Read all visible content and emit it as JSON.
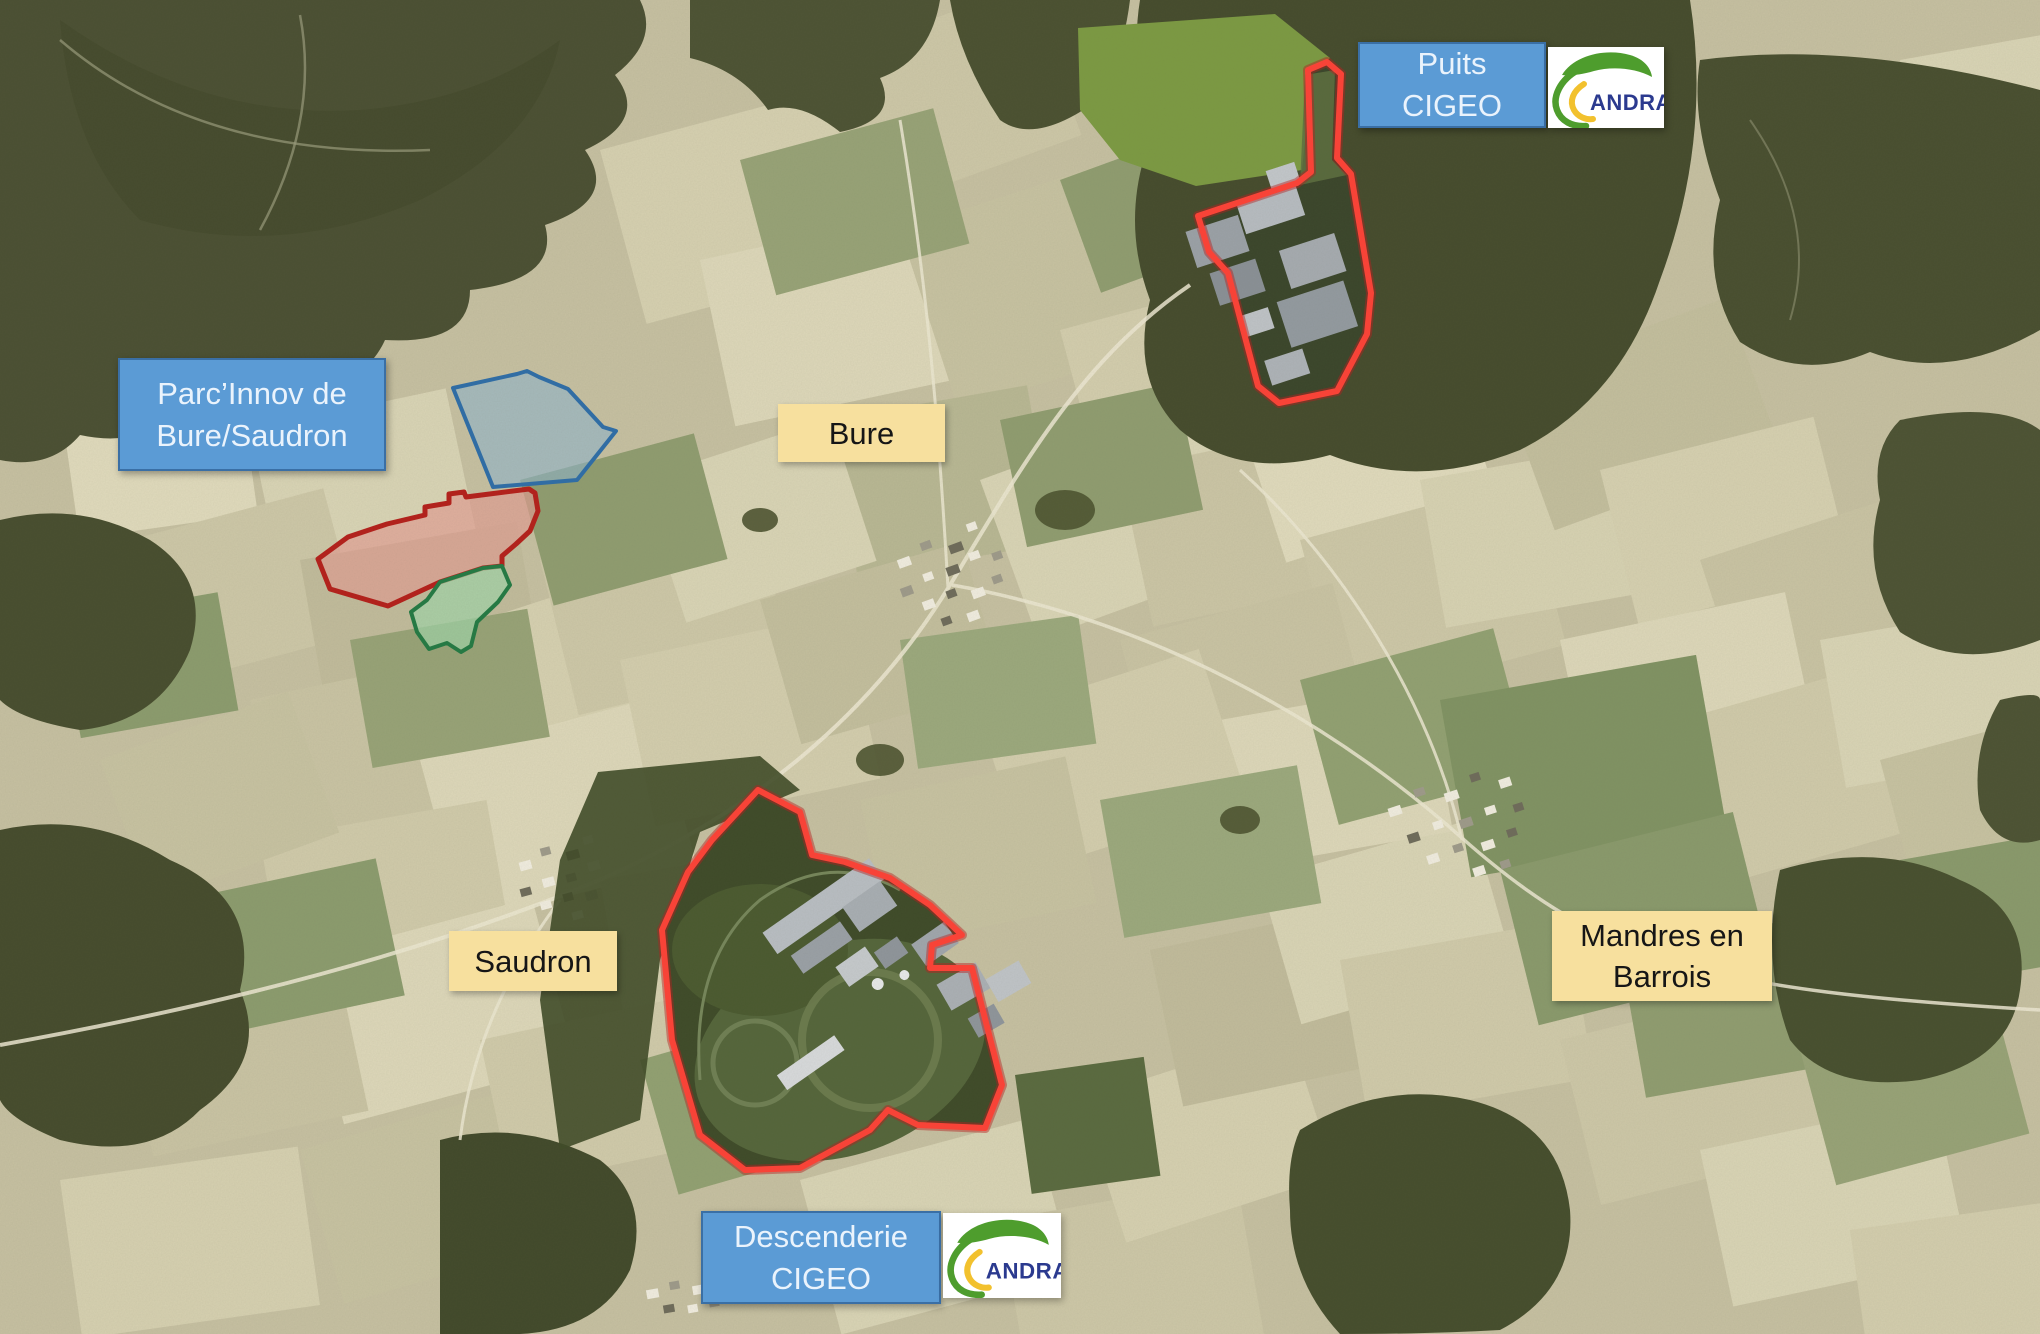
{
  "labels": {
    "puits": {
      "line1": "Puits",
      "line2": "CIGEO"
    },
    "parcinnov": {
      "line1": "Parc’Innov de",
      "line2": "Bure/Saudron"
    },
    "bure": "Bure",
    "saudron": "Saudron",
    "mandres": {
      "line1": "Mandres en",
      "line2": "Barrois"
    },
    "descenderie": {
      "line1": "Descenderie",
      "line2": "CIGEO"
    }
  },
  "logo": {
    "text": "ANDRA"
  },
  "legend_colors": {
    "label_blue_bg": "#5B9BD5",
    "label_blue_border": "#3A6FA5",
    "label_blue_text": "#EAF3FC",
    "label_yellow_bg": "#F7E09E",
    "label_yellow_text": "#161616",
    "site_outline_red": "#FF4136",
    "site_outline_red_dark": "#B71C1C",
    "zone_blue_fill": "#8FB4CC",
    "zone_blue_border": "#2E6DA8",
    "zone_red_fill": "#E29C92",
    "zone_red_border": "#B51F1A",
    "zone_green_fill": "#9FD4A8",
    "zone_green_border": "#237A43",
    "andra_blue": "#2B3A8F",
    "andra_green": "#4E9D2D",
    "andra_yellow": "#F2C12E"
  }
}
